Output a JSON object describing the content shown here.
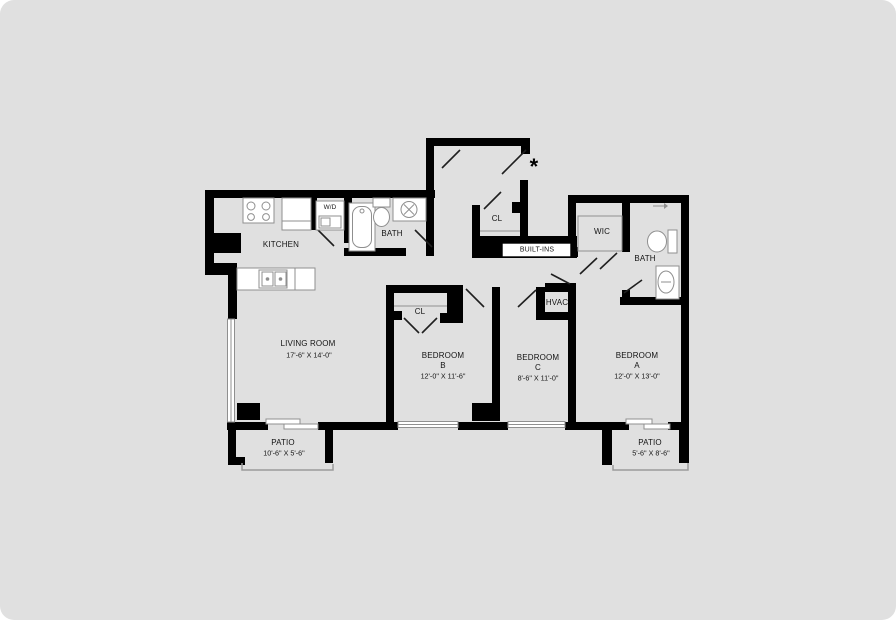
{
  "plan": {
    "entry_marker": "*",
    "labels": {
      "kitchen": "KITCHEN",
      "laundry": "W/D",
      "bath_left": "BATH",
      "closet_entry": "CL",
      "built_ins": "BUILT-INS",
      "wic": "WIC",
      "bath_right": "BATH",
      "living_room": "LIVING ROOM",
      "living_room_dims": "17'-6\" X 14'-0\"",
      "closet_bedroom_b": "CL",
      "hvac": "HVAC",
      "bedroom_b": "BEDROOM",
      "bedroom_b_letter": "B",
      "bedroom_b_dims": "12'-0\" X 11'-6\"",
      "bedroom_c": "BEDROOM",
      "bedroom_c_letter": "C",
      "bedroom_c_dims": "8'-6\" X 11'-0\"",
      "bedroom_a": "BEDROOM",
      "bedroom_a_letter": "A",
      "bedroom_a_dims": "12'-0\" X 13'-0\"",
      "patio_left": "PATIO",
      "patio_left_dims": "10'-6\" X 5'-6\"",
      "patio_right": "PATIO",
      "patio_right_dims": "5'-6\" X 8'-6\""
    },
    "colors": {
      "wall": "#000000",
      "floor": "#e0e0e0",
      "fixture_stroke": "#8f8f8f"
    }
  }
}
